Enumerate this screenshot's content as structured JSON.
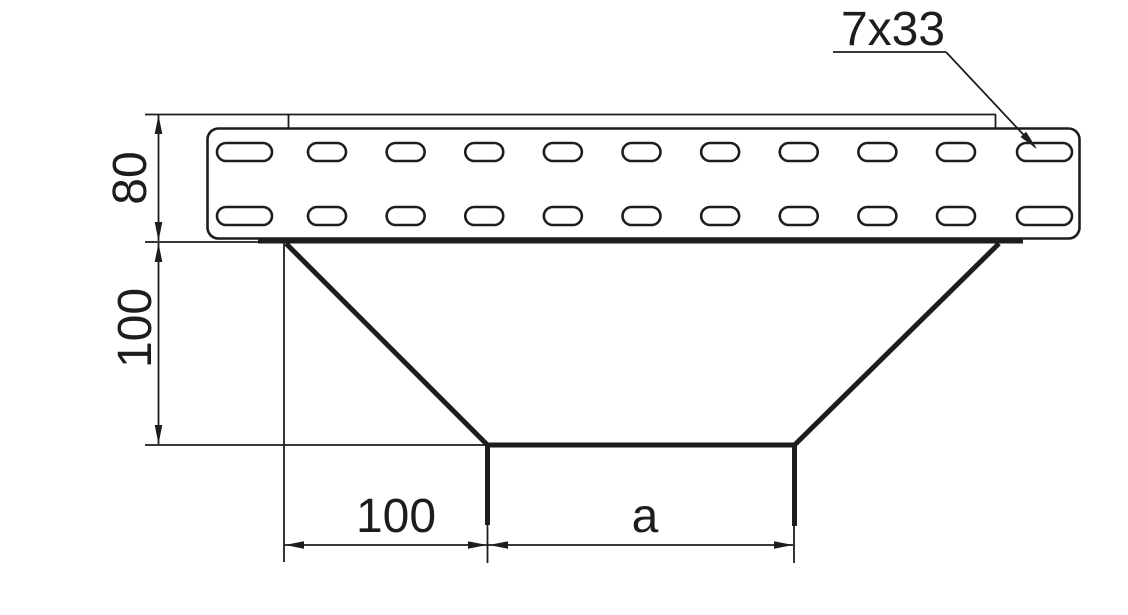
{
  "drawing": {
    "kind": "cable-tray-reducer-side-view",
    "labels": {
      "slot_size": "7x33",
      "rail_height": "80",
      "drop_height": "100",
      "bottom_offset": "100",
      "bottom_width": "a"
    },
    "colors": {
      "line": "#1d1d1b",
      "background": "#ffffff"
    },
    "perforation": {
      "rows": 2,
      "slots_per_row": 11,
      "wide_end_slots": 2
    }
  }
}
